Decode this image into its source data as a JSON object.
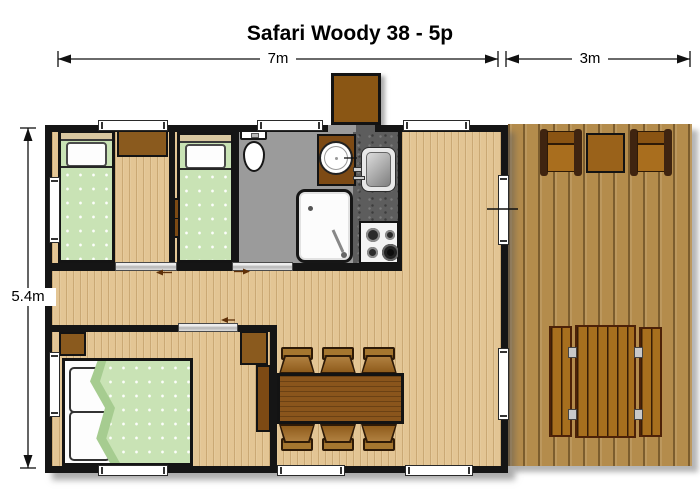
{
  "title": "Safari Woody 38 - 5p",
  "dimensions": {
    "cabin_width": "7m",
    "terrace_width": "3m",
    "depth": "5.4m"
  },
  "colors": {
    "wall": "#151515",
    "interior_wood": "#e3c594",
    "terrace_wood": "#b48c4c",
    "bathroom_floor": "#9b9b9b",
    "kitchen_counter": "#5d5d5d",
    "furniture_brown": "#8a5a1e",
    "bed_green": "#c9e3b5",
    "fixture_white": "#ffffff"
  },
  "elements": {
    "bedrooms": [
      "single-bed",
      "single-bed",
      "double-bed"
    ],
    "bathroom": [
      "toilet",
      "washbasin",
      "shower"
    ],
    "kitchen": [
      "sink",
      "stove"
    ],
    "living": [
      "dining-table",
      "6-chairs",
      "wardrobe"
    ],
    "terrace": [
      "armchair",
      "side-table",
      "armchair",
      "picnic-table"
    ],
    "entrance": [
      "step"
    ]
  }
}
